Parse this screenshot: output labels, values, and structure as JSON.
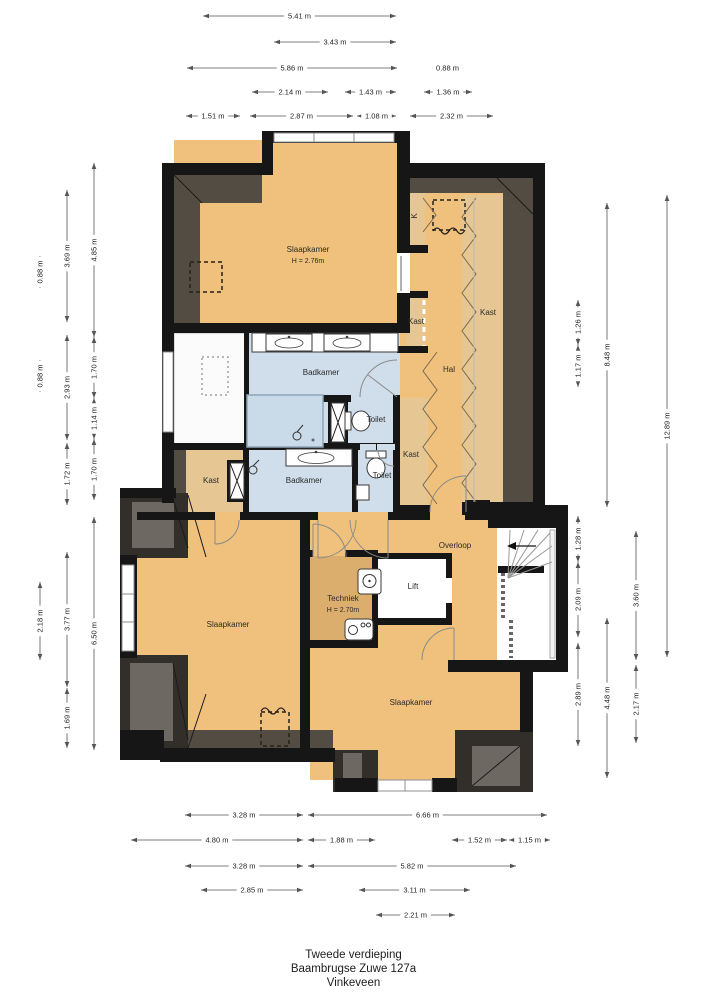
{
  "footer": {
    "line1": "Tweede verdieping",
    "line2": "Baambrugse Zuwe 127a",
    "line3": "Vinkeveen"
  },
  "colors": {
    "floor_orange": "#f0c17c",
    "closet_tan": "#e6c692",
    "wet_room_blue": "#cfdeea",
    "technical_tan": "#dcae6e",
    "wall_black": "#161616",
    "roof_slope_gray": "#534c42",
    "dormer_dark": "#322f2b",
    "dormer_inner_gray": "#6d6862"
  },
  "rooms": [
    {
      "name": "room-slaapkamer-topleft",
      "label": "Slaapkamer",
      "sub": "H = 2.76m",
      "x": 308,
      "y": 252
    },
    {
      "name": "room-hal",
      "label": "Hal",
      "x": 449,
      "y": 372
    },
    {
      "name": "room-kast-right",
      "label": "Kast",
      "x": 488,
      "y": 315,
      "size": 7
    },
    {
      "name": "room-kast-top",
      "label": "Kast",
      "x": 416,
      "y": 324,
      "size": 7
    },
    {
      "name": "room-k-closet",
      "label": "K",
      "x": 417,
      "y": 216,
      "size": 7,
      "rotate": -90
    },
    {
      "name": "room-badkamer-boven",
      "label": "Badkamer",
      "x": 321,
      "y": 375
    },
    {
      "name": "room-toilet-boven",
      "label": "Toilet",
      "x": 376,
      "y": 422,
      "size": 7
    },
    {
      "name": "room-kast-mid",
      "label": "Kast",
      "x": 411,
      "y": 457,
      "size": 7
    },
    {
      "name": "room-kast-links",
      "label": "Kast",
      "x": 211,
      "y": 483,
      "size": 7
    },
    {
      "name": "room-badkamer-onder",
      "label": "Badkamer",
      "x": 304,
      "y": 483
    },
    {
      "name": "room-toilet-onder",
      "label": "Toilet",
      "x": 382,
      "y": 478,
      "size": 7
    },
    {
      "name": "room-overloop",
      "label": "Overloop",
      "x": 455,
      "y": 548
    },
    {
      "name": "room-lift",
      "label": "Lift",
      "x": 413,
      "y": 589
    },
    {
      "name": "room-techniek",
      "label": "Techniek",
      "sub": "H = 2.70m",
      "x": 343,
      "y": 601
    },
    {
      "name": "room-slaapkamer-bottomleft",
      "label": "Slaapkamer",
      "x": 228,
      "y": 627
    },
    {
      "name": "room-slaapkamer-bottomright",
      "label": "Slaapkamer",
      "x": 411,
      "y": 705
    }
  ],
  "dimensions": {
    "top": [
      {
        "label": "5.41 m",
        "x1": 203,
        "x2": 396,
        "y": 16
      },
      {
        "label": "3.43 m",
        "x1": 274,
        "x2": 396,
        "y": 42
      },
      {
        "label": "5.86 m",
        "x1": 187,
        "x2": 397,
        "y": 68
      },
      {
        "label": "0.88 m",
        "x1": 432,
        "x2": 463,
        "y": 68
      },
      {
        "label": "2.14 m",
        "x1": 252,
        "x2": 328,
        "y": 92
      },
      {
        "label": "1.43 m",
        "x1": 345,
        "x2": 396,
        "y": 92
      },
      {
        "label": "1.36 m",
        "x1": 424,
        "x2": 472,
        "y": 92
      },
      {
        "label": "1.51 m",
        "x1": 186,
        "x2": 240,
        "y": 116
      },
      {
        "label": "2.87 m",
        "x1": 250,
        "x2": 353,
        "y": 116
      },
      {
        "label": "1.08 m",
        "x1": 357,
        "x2": 396,
        "y": 116
      },
      {
        "label": "2.32 m",
        "x1": 410,
        "x2": 493,
        "y": 116
      }
    ],
    "bottom": [
      {
        "label": "3.28 m",
        "x1": 185,
        "x2": 303,
        "y": 815
      },
      {
        "label": "6.66 m",
        "x1": 308,
        "x2": 547,
        "y": 815
      },
      {
        "label": "4.80 m",
        "x1": 131,
        "x2": 303,
        "y": 840
      },
      {
        "label": "1.88 m",
        "x1": 308,
        "x2": 375,
        "y": 840
      },
      {
        "label": "1.52 m",
        "x1": 452,
        "x2": 507,
        "y": 840
      },
      {
        "label": "1.15 m",
        "x1": 509,
        "x2": 550,
        "y": 840
      },
      {
        "label": "3.28 m",
        "x1": 185,
        "x2": 303,
        "y": 866
      },
      {
        "label": "5.82 m",
        "x1": 308,
        "x2": 516,
        "y": 866
      },
      {
        "label": "2.85 m",
        "x1": 201,
        "x2": 303,
        "y": 890
      },
      {
        "label": "3.11 m",
        "x1": 359,
        "x2": 470,
        "y": 890
      },
      {
        "label": "2.21 m",
        "x1": 376,
        "x2": 455,
        "y": 915
      }
    ],
    "left": [
      {
        "label": "0.88 m",
        "x": 40,
        "y1": 256,
        "y2": 288
      },
      {
        "label": "0.88 m",
        "x": 40,
        "y1": 360,
        "y2": 392
      },
      {
        "label": "2.18 m",
        "x": 40,
        "y1": 582,
        "y2": 660
      },
      {
        "label": "3.69 m",
        "x": 67,
        "y1": 190,
        "y2": 322
      },
      {
        "label": "2.93 m",
        "x": 67,
        "y1": 335,
        "y2": 440
      },
      {
        "label": "1.72 m",
        "x": 67,
        "y1": 443,
        "y2": 505
      },
      {
        "label": "3.77 m",
        "x": 67,
        "y1": 552,
        "y2": 687
      },
      {
        "label": "1.69 m",
        "x": 67,
        "y1": 688,
        "y2": 748
      },
      {
        "label": "4.85 m",
        "x": 94,
        "y1": 163,
        "y2": 337
      },
      {
        "label": "1.70 m",
        "x": 94,
        "y1": 337,
        "y2": 398
      },
      {
        "label": "1.14 m",
        "x": 94,
        "y1": 398,
        "y2": 439
      },
      {
        "label": "1.70 m",
        "x": 94,
        "y1": 439,
        "y2": 500
      },
      {
        "label": "6.50 m",
        "x": 94,
        "y1": 517,
        "y2": 750
      }
    ],
    "right": [
      {
        "label": "1.26 m",
        "x": 578,
        "y1": 300,
        "y2": 345
      },
      {
        "label": "1.17 m",
        "x": 578,
        "y1": 345,
        "y2": 387
      },
      {
        "label": "1.28 m",
        "x": 578,
        "y1": 516,
        "y2": 562
      },
      {
        "label": "2.09 m",
        "x": 578,
        "y1": 562,
        "y2": 637
      },
      {
        "label": "2.89 m",
        "x": 578,
        "y1": 643,
        "y2": 746
      },
      {
        "label": "8.48 m",
        "x": 607,
        "y1": 203,
        "y2": 507
      },
      {
        "label": "4.48 m",
        "x": 607,
        "y1": 618,
        "y2": 778
      },
      {
        "label": "3.60 m",
        "x": 636,
        "y1": 531,
        "y2": 660
      },
      {
        "label": "2.17 m",
        "x": 636,
        "y1": 665,
        "y2": 743
      },
      {
        "label": "12.89 m",
        "x": 667,
        "y1": 195,
        "y2": 657
      }
    ]
  }
}
